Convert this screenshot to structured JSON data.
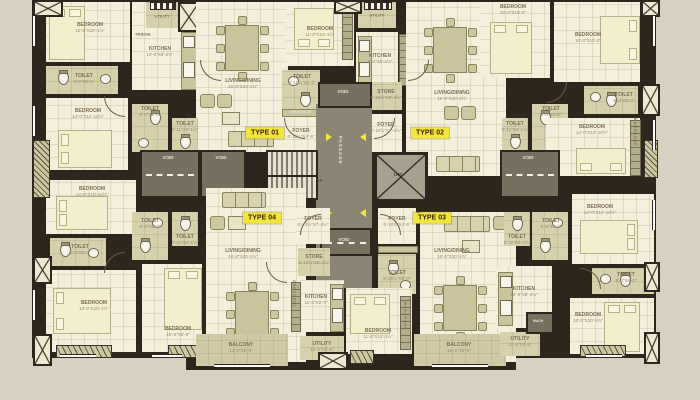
{
  "palette": {
    "background": "#d8d1c2",
    "wall": "#2e251c",
    "floor_cream": "#f4efda",
    "floor_olive": "#d6d1ab",
    "core_gray": "#8d8574",
    "highlight_yellow": "#f2e63e",
    "type_text": "#42210b"
  },
  "types": {
    "t1": "TYPE 01",
    "t2": "TYPE 02",
    "t3": "TYPE 03",
    "t4": "TYPE 04"
  },
  "core": {
    "passage": "PASSAGE",
    "lift": "LIFT",
    "up": "UP",
    "void": "VOID"
  },
  "units": {
    "t1": {
      "rooms": {
        "bed1": {
          "n": "BEDROOM",
          "d": "10'-0\"X10'-1½\""
        },
        "bedC": {
          "n": "BEDROOM",
          "d": "11'-0\"X13'-1½\""
        },
        "bed2": {
          "n": "BEDROOM",
          "d": "14'-0\"X11'-10½\""
        },
        "toilet1": {
          "n": "TOILET",
          "d": "5'-0\"X8'-0\""
        },
        "kitchen": {
          "n": "KITCHEN",
          "d": "10'-0\"X8'-2½\""
        },
        "fridge": {
          "n": "FRIDGE",
          "d": ""
        },
        "utility": {
          "n": "UTILITY",
          "d": "10'-0\"X3'-0\""
        },
        "living": {
          "n": "LIVING/DINING",
          "d": "16'-0\"X20'-2½\""
        },
        "toilet2": {
          "n": "TOILET",
          "d": "5'-0\"X8'-0\""
        },
        "toilet3": {
          "n": "TOILET",
          "d": "5'-11\"X4'-1½\""
        },
        "toilet4": {
          "n": "TOILET",
          "d": "6'-10½\"X5'-0\""
        },
        "foyer": {
          "n": "FOYER",
          "d": "6'-10½\"X4'-6\""
        },
        "shoerack": {
          "n": "SHOE RACK",
          "d": ""
        }
      }
    },
    "t2": {
      "rooms": {
        "utility": {
          "n": "UTILITY",
          "d": "7'-0\"X3'-0\""
        },
        "kitchen": {
          "n": "KITCHEN",
          "d": "9'-0\"X8'-2½\""
        },
        "store": {
          "n": "STORE",
          "d": "6'-10½\"X5'-4½\""
        },
        "foyer": {
          "n": "FOYER",
          "d": "6'-10½\"X7'-4½\""
        },
        "living": {
          "n": "LIVING/DINING",
          "d": "16'-0\"X20'-2½\""
        },
        "bed1": {
          "n": "BEDROOM",
          "d": "10'-0\"X10'-0\""
        },
        "bed2": {
          "n": "BEDROOM",
          "d": "10'-0\"X13'-0\""
        },
        "bed3": {
          "n": "BEDROOM",
          "d": "14'-0\"X10'-10½\""
        },
        "toilet1": {
          "n": "TOILET",
          "d": "5'-0\"X8'-0\""
        },
        "toilet2": {
          "n": "TOILET",
          "d": "5'-0\"X8'-0\""
        },
        "toilet3": {
          "n": "TOILET",
          "d": "5'-11\"X4'-1½\""
        },
        "wardrobe": {
          "n": "WARDROBE",
          "d": ""
        }
      }
    },
    "t3": {
      "rooms": {
        "foyer": {
          "n": "FOYER",
          "d": "6'-10½\"X4'-6\""
        },
        "toilet4": {
          "n": "TOILET",
          "d": "6'-10½\"X5'-0\""
        },
        "living": {
          "n": "LIVING/DINING",
          "d": "16'-0\"X20'-2½\""
        },
        "toilet2": {
          "n": "TOILET",
          "d": "5'-0\"X8'-0\""
        },
        "toilet3": {
          "n": "TOILET",
          "d": "5'-11\"X4'-1½\""
        },
        "bedC": {
          "n": "BEDROOM",
          "d": "11'-0\"X13'-1½\""
        },
        "wardrobe": {
          "n": "WARDROBE",
          "d": ""
        },
        "kitchen": {
          "n": "KITCHEN",
          "d": "10'-0\"X8'-0½\""
        },
        "utility": {
          "n": "UTILITY",
          "d": "11'-0\"X3'-6\""
        },
        "wash": {
          "n": "WASH",
          "d": ""
        },
        "balcony": {
          "n": "BALCONY",
          "d": "14'-0\"X5'-0\""
        },
        "bed2": {
          "n": "BEDROOM",
          "d": "14'-0\"X10'-10½\""
        },
        "toilet1": {
          "n": "TOILET",
          "d": "5'-0\"X8'-0\""
        },
        "bed1": {
          "n": "BEDROOM",
          "d": "10'-0\"X10'-1½\""
        }
      }
    },
    "t4": {
      "rooms": {
        "foyer": {
          "n": "FOYER",
          "d": "6'-10½\"X7'-4½\""
        },
        "store": {
          "n": "STORE",
          "d": "6'-10½\"X5'-4½\""
        },
        "kitchen": {
          "n": "KITCHEN",
          "d": "11'-0\"X8'-0\""
        },
        "crockery": {
          "n": "CROCKERY",
          "d": ""
        },
        "utility": {
          "n": "UTILITY",
          "d": "11'-0\"X3'-6\""
        },
        "living": {
          "n": "LIVING/DINING",
          "d": "16'-0\"X20'-2½\""
        },
        "balcony": {
          "n": "BALCONY",
          "d": "14'-0\"X5'-0\""
        },
        "bed3": {
          "n": "BEDROOM",
          "d": "14'-0\"X10'-10½\""
        },
        "toilet1": {
          "n": "TOILET",
          "d": "5'-0\"X8'-0\""
        },
        "toilet2": {
          "n": "TOILET",
          "d": "5'-0\"X8'-0\""
        },
        "toilet3": {
          "n": "TOILET",
          "d": "5'-11\"X4'-1½\""
        },
        "bed2": {
          "n": "BEDROOM",
          "d": "14'-0\"X10'-1½\""
        },
        "bed1": {
          "n": "BEDROOM",
          "d": "10'-0\"X8'-0\""
        }
      }
    }
  }
}
